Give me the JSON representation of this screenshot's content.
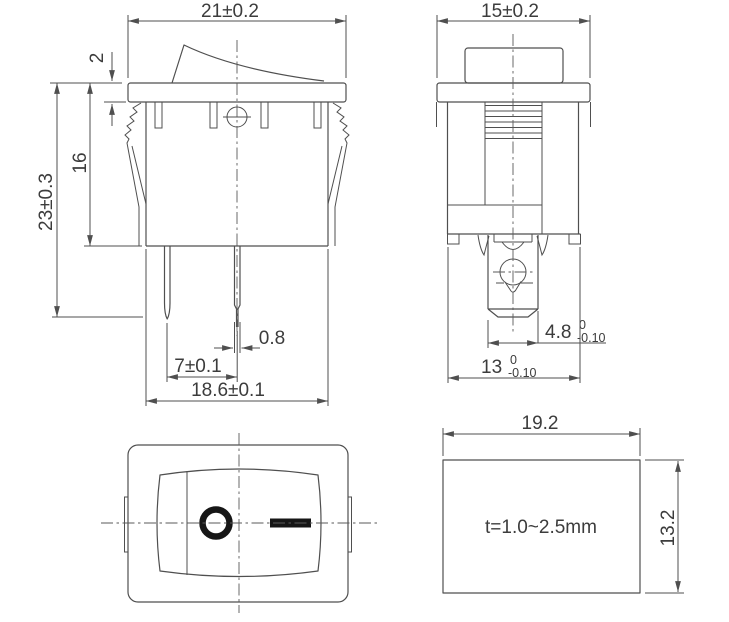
{
  "title": "Rocker switch dimensional drawing",
  "front_view": {
    "dims": {
      "top_width": "21±0.2",
      "flange_thickness": "2",
      "body_height": "16",
      "overall_height": "23±0.3",
      "pin_thickness": "0.8",
      "pin_pitch": "7±0.1",
      "body_width": "18.6±0.1"
    }
  },
  "side_view": {
    "dims": {
      "top_width": "15±0.2",
      "terminal_width": {
        "nominal": "4.8",
        "tol_upper": "0",
        "tol_lower": "-0.10"
      },
      "snapin_width": {
        "nominal": "13",
        "tol_upper": "0",
        "tol_lower": "-0.10"
      }
    }
  },
  "face_view": {
    "off_symbol": "O",
    "on_symbol": "—"
  },
  "panel_cutout": {
    "dims": {
      "width": "19.2",
      "height": "13.2"
    },
    "thickness_note": "t=1.0~2.5mm"
  },
  "colors": {
    "line": "#4f4f4f",
    "text": "#3c3c3c",
    "symbol": "#161616",
    "background": "#ffffff"
  }
}
